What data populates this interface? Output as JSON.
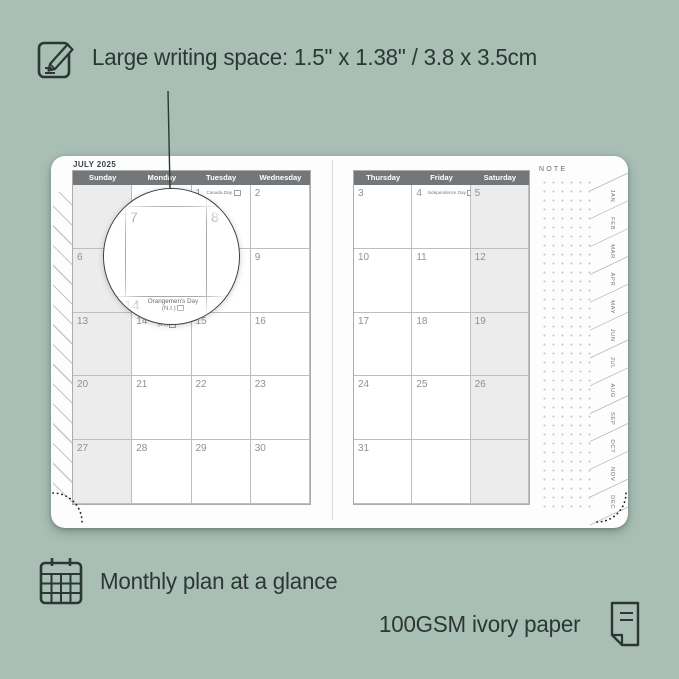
{
  "colors": {
    "background": "#a9beb5",
    "ink": "#2c3733",
    "header_bg": "#747779",
    "shaded_cell": "#ececec",
    "grid_line": "#bcbfc0",
    "date_number": "#8e9193",
    "magnifier_ring": "#3b403f",
    "dot_grid": "#c6c8c8"
  },
  "annotations": {
    "top_feature": {
      "icon": "note-pencil-icon",
      "text": "Large writing space: 1.5\" x 1.38\" / 3.8 x 3.5cm"
    },
    "bottom_left_feature": {
      "icon": "calendar-grid-icon",
      "text": "Monthly plan at a glance"
    },
    "bottom_right_feature": {
      "icon": "folded-paper-icon",
      "text": "100GSM ivory paper"
    }
  },
  "planner": {
    "month_title": "JULY 2025",
    "note_label": "NOTE",
    "left_page": {
      "headers": [
        "Sunday",
        "Monday",
        "Tuesday",
        "Wednesday"
      ],
      "days": [
        "",
        "",
        "1",
        "2",
        "6",
        "7",
        "8",
        "9",
        "13",
        "14",
        "15",
        "16",
        "20",
        "21",
        "22",
        "23",
        "27",
        "28",
        "29",
        "30"
      ],
      "holidays": {
        "canada_day": "Canada Day",
        "orangemens_line1": "Orangemen's Day",
        "orangemens_line2": "(N.I.)"
      }
    },
    "right_page": {
      "headers": [
        "Thursday",
        "Friday",
        "Saturday"
      ],
      "days": [
        "3",
        "4",
        "5",
        "10",
        "11",
        "12",
        "17",
        "18",
        "19",
        "24",
        "25",
        "26",
        "31",
        "",
        ""
      ],
      "holidays": {
        "independence_day": "Independence Day"
      }
    },
    "month_tabs": [
      "JAN",
      "FEB",
      "MAR",
      "APR",
      "MAY",
      "JUN",
      "JUL",
      "AUG",
      "SEP",
      "OCT",
      "NOV",
      "DEC"
    ],
    "magnifier": {
      "day_top_left": "7",
      "day_top_right": "8",
      "day_bottom": "14",
      "holiday_line1": "Orangemen's Day",
      "holiday_line2": "(N.I.)"
    }
  }
}
